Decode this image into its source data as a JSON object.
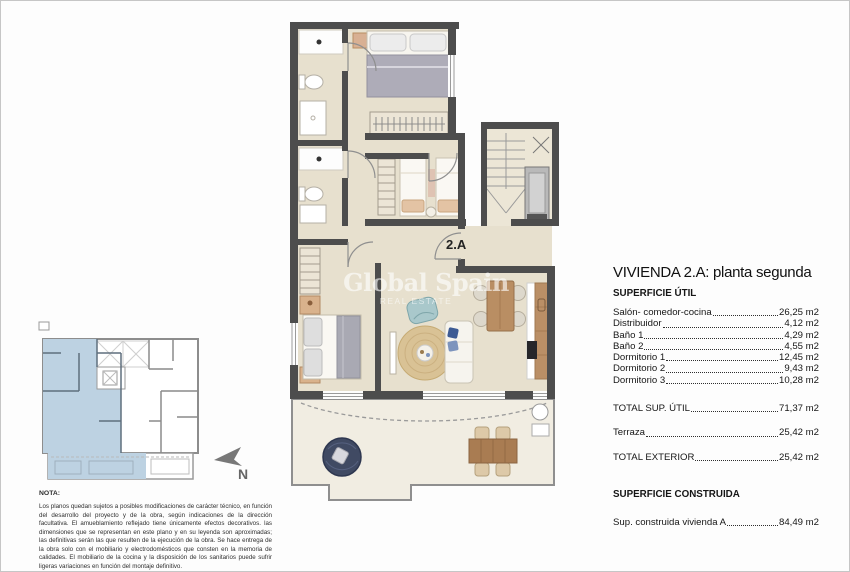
{
  "plan": {
    "unit_label": "2.A",
    "watermark": {
      "title": "Global Spain",
      "subtitle": "REAL ESTATE"
    }
  },
  "compass": {
    "label": "N"
  },
  "details_panel": {
    "title": "VIVIENDA 2.A: planta segunda",
    "section1_heading": "SUPERFICIE ÚTIL",
    "rows": [
      {
        "label": "Salón- comedor-cocina",
        "value": "26,25 m2"
      },
      {
        "label": "Distribuidor",
        "value": "4,12 m2"
      },
      {
        "label": "Baño 1",
        "value": "4,29 m2"
      },
      {
        "label": "Baño 2",
        "value": "4,55 m2"
      },
      {
        "label": "Dormitorio 1",
        "value": "12,45 m2"
      },
      {
        "label": "Dormitorio 2",
        "value": "9,43 m2"
      },
      {
        "label": "Dormitorio 3",
        "value": "10,28 m2"
      }
    ],
    "total_util": {
      "label": "TOTAL SUP. ÚTIL",
      "value": "71,37 m2"
    },
    "terraza": {
      "label": "Terraza",
      "value": "25,42 m2"
    },
    "total_exterior": {
      "label": "TOTAL EXTERIOR",
      "value": "25,42 m2"
    },
    "section2_heading": "SUPERFICIE CONSTRUIDA",
    "construida": {
      "label": "Sup. construida vivienda A",
      "value": "84,49 m2"
    }
  },
  "note": {
    "heading": "NOTA:",
    "body": "Los planos quedan sujetos a posibles modificaciones de carácter técnico, en función del desarrollo del proyecto y de la obra, según indicaciones de la dirección facultativa. El amueblamiento reflejado tiene únicamente efectos decorativos. las dimensiones que se representan en este plano y en su leyenda son aproximadas; las definitivas serán las que resulten de la ejecución de la obra. Se hace entrega de la obra solo con el mobiliario y electrodomésticos que consten en la memoria de calidades. El mobiliario de la cocina y la disposición de los sanitarios puede sufrir ligeras variaciones en función del montaje definitivo."
  },
  "colors": {
    "wall": "#4d4d4d",
    "floor": "#e7e0ce",
    "terrace_floor": "#f1ede2",
    "highlight_blue": "#bdd2e2",
    "wood": "#b98e63",
    "navy": "#404a63",
    "teal": "#a9c8cb",
    "rug": "#d9c295"
  }
}
